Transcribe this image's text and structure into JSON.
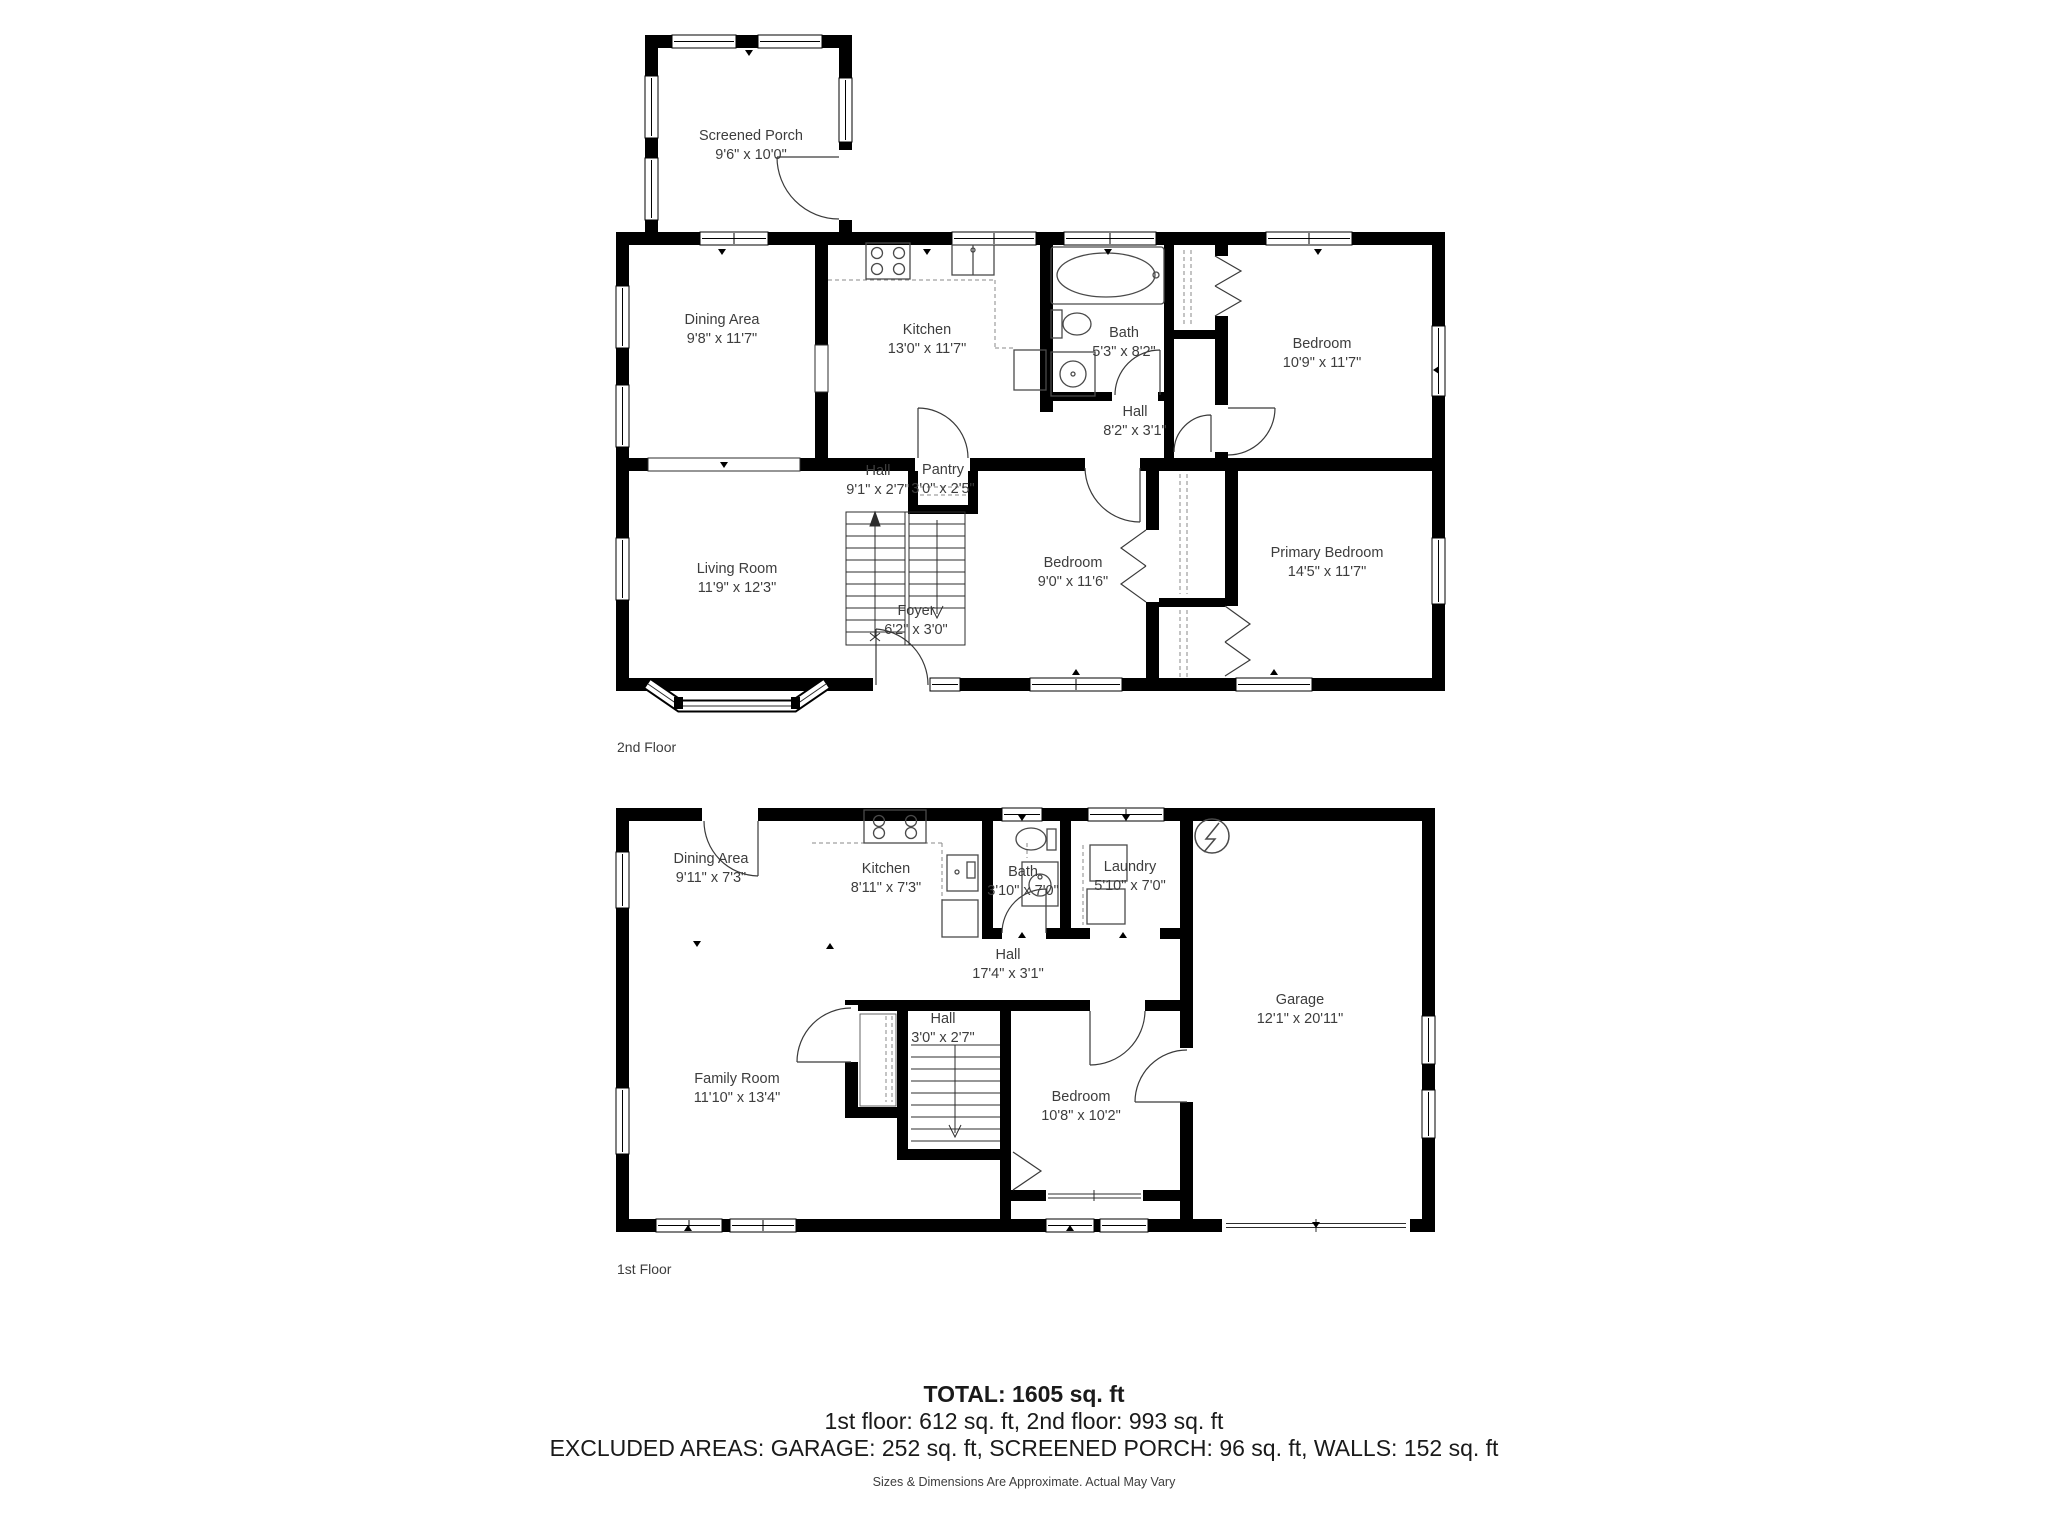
{
  "floor2": {
    "caption": "2nd Floor",
    "rooms": [
      {
        "name": "Screened Porch",
        "dims": "9'6\" x 10'0\""
      },
      {
        "name": "Dining Area",
        "dims": "9'8\" x 11'7\""
      },
      {
        "name": "Kitchen",
        "dims": "13'0\" x 11'7\""
      },
      {
        "name": "Bath",
        "dims": "5'3\" x 8'2\""
      },
      {
        "name": "Hall",
        "dims": "8'2\" x 3'1\""
      },
      {
        "name": "Bedroom",
        "dims": "10'9\" x 11'7\""
      },
      {
        "name": "Hall",
        "dims": "9'1\" x 2'7\""
      },
      {
        "name": "Pantry",
        "dims": "3'0\" x 2'5\""
      },
      {
        "name": "Living Room",
        "dims": "11'9\" x 12'3\""
      },
      {
        "name": "Foyer",
        "dims": "6'2\" x 3'0\""
      },
      {
        "name": "Bedroom",
        "dims": "9'0\" x 11'6\""
      },
      {
        "name": "Primary Bedroom",
        "dims": "14'5\" x 11'7\""
      }
    ]
  },
  "floor1": {
    "caption": "1st Floor",
    "rooms": [
      {
        "name": "Dining Area",
        "dims": "9'11\" x 7'3\""
      },
      {
        "name": "Kitchen",
        "dims": "8'11\" x 7'3\""
      },
      {
        "name": "Bath",
        "dims": "3'10\" x 7'0\""
      },
      {
        "name": "Laundry",
        "dims": "5'10\" x 7'0\""
      },
      {
        "name": "Hall",
        "dims": "17'4\" x 3'1\""
      },
      {
        "name": "Garage",
        "dims": "12'1\" x 20'11\""
      },
      {
        "name": "Family Room",
        "dims": "11'10\" x 13'4\""
      },
      {
        "name": "Hall",
        "dims": "3'0\" x 2'7\""
      },
      {
        "name": "Bedroom",
        "dims": "10'8\" x 10'2\""
      }
    ]
  },
  "summary": {
    "total": "TOTAL: 1605 sq. ft",
    "floors": "1st floor: 612 sq. ft, 2nd floor: 993 sq. ft",
    "excluded": "EXCLUDED AREAS: GARAGE: 252 sq. ft, SCREENED PORCH: 96 sq. ft, WALLS: 152 sq. ft",
    "disclaimer": "Sizes & Dimensions Are Approximate. Actual May Vary"
  },
  "colors": {
    "wall": "#000000",
    "text": "#3d3d3d"
  }
}
